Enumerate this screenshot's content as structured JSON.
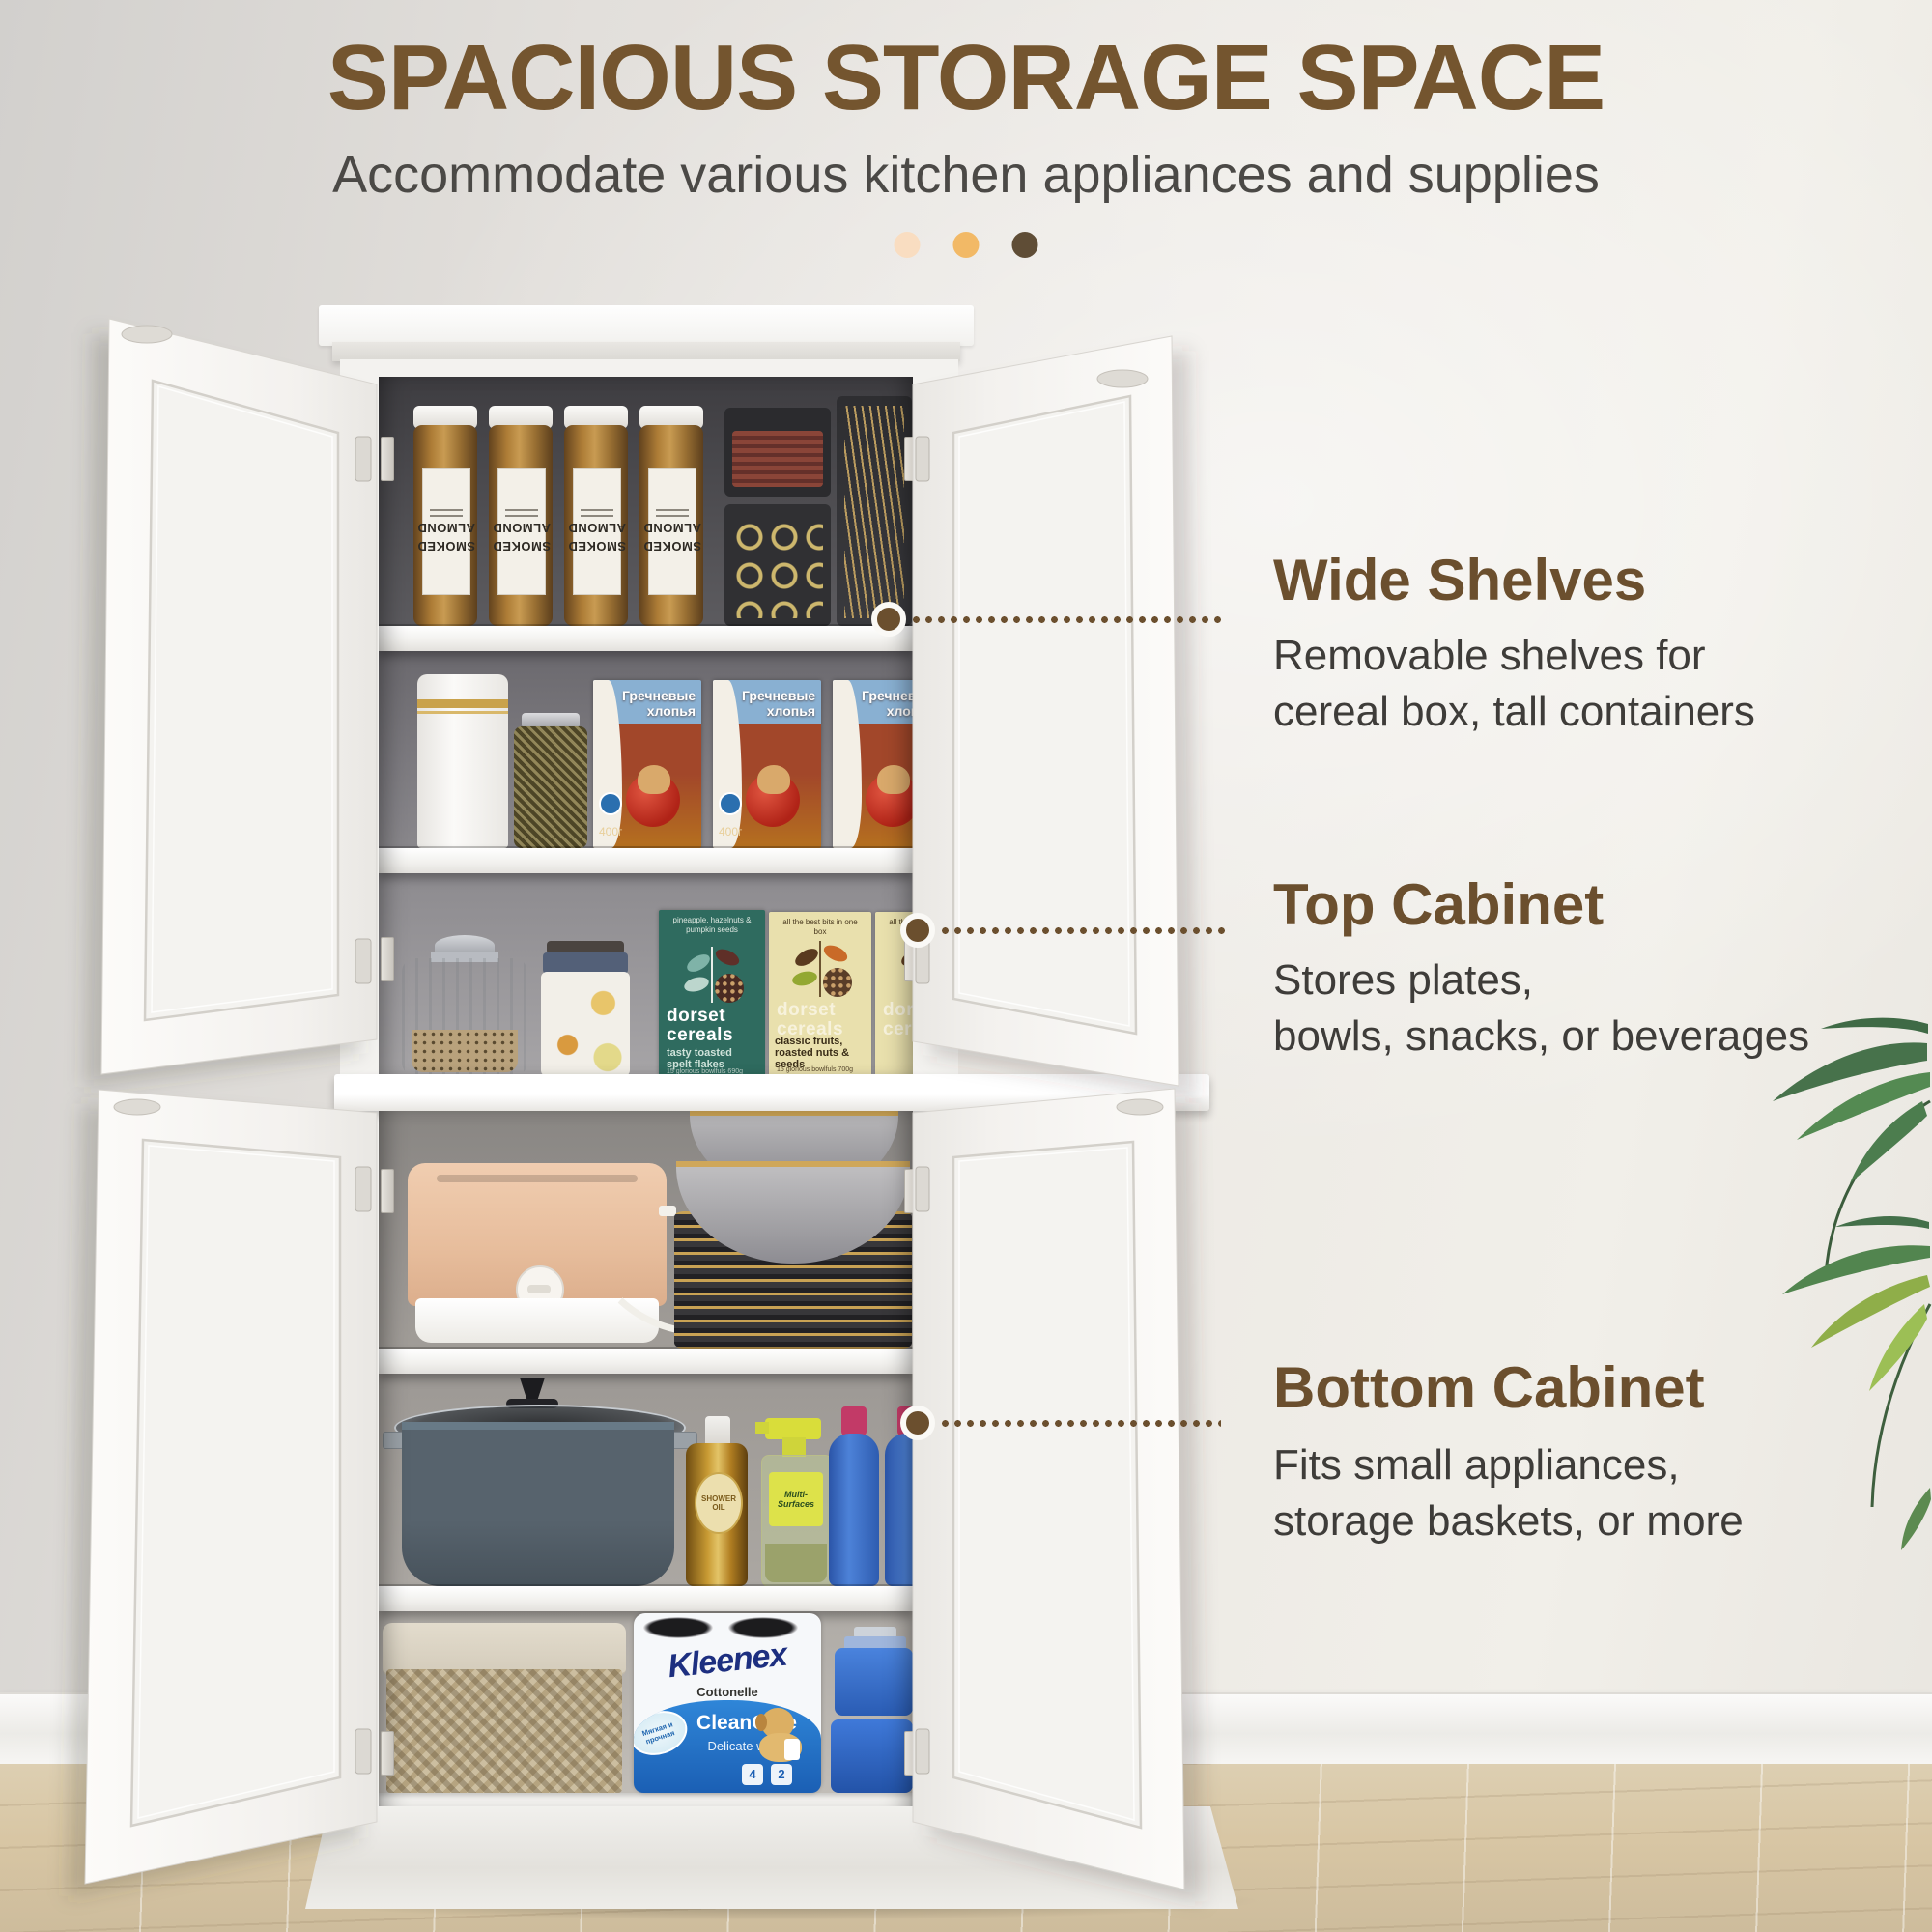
{
  "header": {
    "title": "SPACIOUS STORAGE SPACE",
    "subtitle": "Accommodate various kitchen appliances and supplies",
    "dots": [
      "#f9ddc1",
      "#f2b966",
      "#5f4d36"
    ]
  },
  "callouts": [
    {
      "title": "Wide Shelves",
      "line1": "Removable shelves for",
      "line2": "cereal box, tall containers"
    },
    {
      "title": "Top Cabinet",
      "line1": "Stores plates,",
      "line2": "bowls, snacks, or beverages"
    },
    {
      "title": "Bottom Cabinet",
      "line1": "Fits small appliances,",
      "line2": "storage baskets, or more"
    }
  ],
  "colors": {
    "accent_brown": "#6b4f2e",
    "body_text": "#3e3c39",
    "wall": "#e9e6e1",
    "floor": "#d8c6a4"
  },
  "products": {
    "jar_label_top": "SMOKED",
    "jar_label_bottom": "ALMOND",
    "cereal_title_line1": "Гречневые",
    "cereal_title_line2": "хлопья",
    "cereal_weight": "400г",
    "dorset_note_teal": "pineapple, hazelnuts & pumpkin seeds",
    "dorset_brand_line1": "dorset",
    "dorset_brand_line2": "cereals",
    "dorset_variant_teal_line1": "tasty toasted",
    "dorset_variant_teal_line2": "spelt flakes",
    "dorset_footer_teal": "15 glorious bowlfuls 690g",
    "dorset_note_cream": "all the best bits in one box",
    "dorset_variant_cream": "classic fruits, roasted nuts & seeds",
    "dorset_footer_cream": "15 glorious bowlfuls 700g",
    "oil_label": "SHOWER OIL",
    "spray_label": "Multi-Surfaces",
    "tp_brand": "Kleenex",
    "tp_sub": "Cottonelle",
    "tp_badge": "Мягкая и прочная",
    "tp_care_line1": "CleanCare",
    "tp_care_line2": "Delicate white",
    "tp_count_a": "4",
    "tp_count_b": "2"
  }
}
